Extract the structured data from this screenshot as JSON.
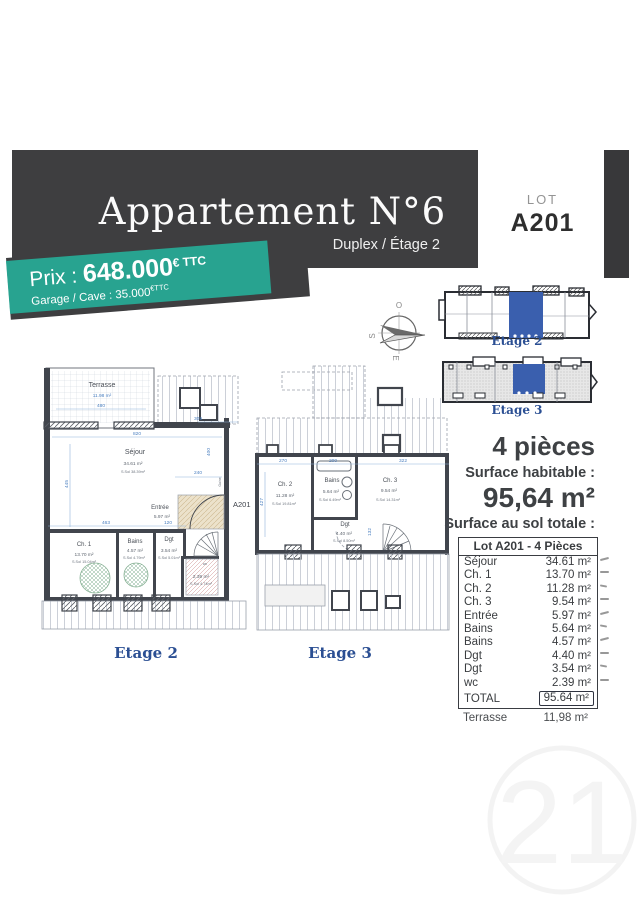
{
  "banner": {
    "title": "Appartement N°6",
    "subtitle": "Duplex / Étage 2"
  },
  "lot": {
    "label": "LOT",
    "number": "A201"
  },
  "price": {
    "label": "Prix : ",
    "amount": "648.000",
    "amount_suffix": "€ TTC",
    "secondary": "Garage / Cave : 35.000",
    "secondary_suffix": "€TTC"
  },
  "colors": {
    "teal": "#28a390",
    "banner_dark": "#3e3e40",
    "caption_blue": "#2b4f93",
    "dim_blue": "#4a7fc0",
    "unit_blue": "#3a5fae"
  },
  "compass": {
    "west": "O",
    "south": "S",
    "east": "E"
  },
  "site_plans": {
    "etage2_caption": "Etage 2",
    "etage3_caption": "Etage 3"
  },
  "summary": {
    "type": "4 pièces",
    "habitable_label": "Surface habitable :",
    "habitable_value": "95,64 m²",
    "sol_label": "Surface au sol totale :",
    "sol_value": "120,77 m²"
  },
  "table": {
    "title": "Lot A201 - 4 Pièces",
    "rows": [
      {
        "label": "Séjour",
        "value": "34.61 m²"
      },
      {
        "label": "Ch. 1",
        "value": "13.70 m²"
      },
      {
        "label": "Ch. 2",
        "value": "11.28 m²"
      },
      {
        "label": "Ch. 3",
        "value": "9.54 m²"
      },
      {
        "label": "Entrée",
        "value": "5.97 m²"
      },
      {
        "label": "Bains",
        "value": "5.64 m²"
      },
      {
        "label": "Bains",
        "value": "4.57 m²"
      },
      {
        "label": "Dgt",
        "value": "4.40 m²"
      },
      {
        "label": "Dgt",
        "value": "3.54 m²"
      },
      {
        "label": "wc",
        "value": "2.39 m²"
      }
    ],
    "total_label": "TOTAL",
    "total_value": "95.64 m²"
  },
  "terrasse_row": {
    "label": "Terrasse",
    "value": "11,98 m²"
  },
  "plan_etage2": {
    "caption": "Etage 2",
    "unit": "A201",
    "gaine": "Gaine",
    "terrasse": {
      "name": "Terrasse",
      "area": "11.98 m²"
    },
    "sejour": {
      "name": "Séjour",
      "area": "34.61 m²",
      "ssol": "S.Sol 38.39m²"
    },
    "entree": {
      "name": "Entrée",
      "area": "5.97 m²"
    },
    "ch1": {
      "name": "Ch. 1",
      "area": "13.70 m²",
      "ssol": "S.Sol 15.04m²"
    },
    "bains": {
      "name": "Bains",
      "area": "4.57 m²",
      "ssol": "S.Sol 4.79m²"
    },
    "dgt": {
      "name": "Dgt",
      "area": "3.54 m²",
      "ssol": "S.Sol 5.01m²"
    },
    "wc": {
      "name": "wc",
      "area": "2.39 m²",
      "ssol": "S.Sol 4.74m²"
    },
    "dims": {
      "d480": "480",
      "d309": "309",
      "d820": "820",
      "d445": "445",
      "d240": "240",
      "d400": "400",
      "d463": "463",
      "d120": "120"
    }
  },
  "plan_etage3": {
    "caption": "Etage 3",
    "ch2": {
      "name": "Ch. 2",
      "area": "11.28 m²",
      "ssol": "S.Sol 19.81m²"
    },
    "bains": {
      "name": "Bains",
      "area": "5.64 m²",
      "ssol": "S.Sol 6.49m²"
    },
    "ch3": {
      "name": "Ch. 3",
      "area": "9.54 m²",
      "ssol": "S.Sol 14.31m²"
    },
    "dgt": {
      "name": "Dgt",
      "area": "4.40 m²",
      "ssol": "S.Sol 8.50m²"
    },
    "dims": {
      "d270": "270",
      "d200": "200",
      "d322": "322",
      "d427": "427",
      "d132": "132"
    }
  },
  "watermark": "21"
}
